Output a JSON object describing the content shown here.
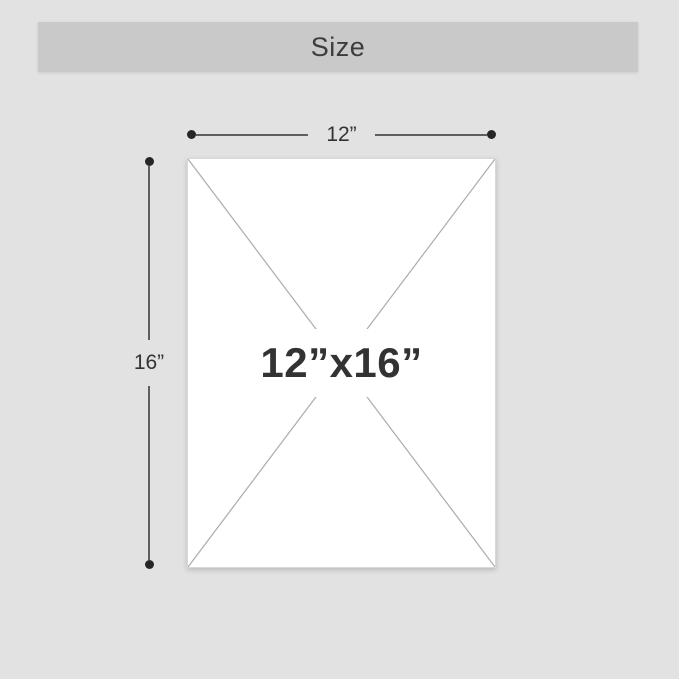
{
  "title_bar": {
    "label": "Size"
  },
  "diagram": {
    "width_label": "12”",
    "height_label": "16”",
    "size_label": "12”x16”"
  },
  "colors": {
    "background": "#e2e2e2",
    "title_bar_bg": "#c9c9c9",
    "title_text": "#3d3d3d",
    "rect_fill": "#ffffff",
    "rect_border": "#d9d9d9",
    "diagonal": "#ababab",
    "dim_line": "#5f5f5f",
    "dim_dot": "#262626",
    "label_text": "#333333"
  }
}
